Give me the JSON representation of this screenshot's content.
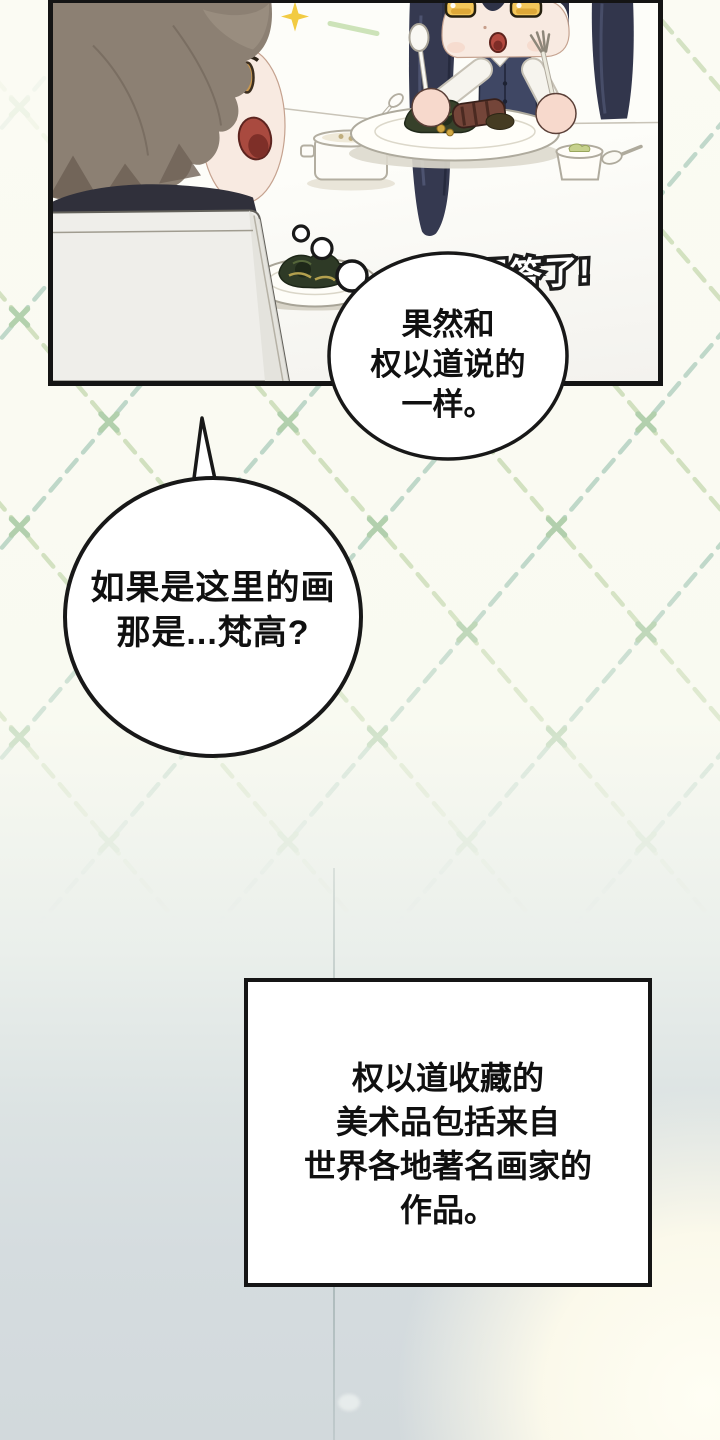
{
  "page": {
    "kind": "webtoon-comic-page",
    "colors": {
      "paper": "#fafaf2",
      "bottom_fade": "#d2d9dc",
      "corner_glow": "#fffdf2",
      "lattice_mint": "#b2d0c0",
      "lattice_green": "#c9dbb5",
      "lattice_cross": "#a3c79e",
      "panel_ink": "#141414",
      "hair_brown": "#8c8073",
      "hair_navy": "#353950",
      "vest_navy": "#3f4764",
      "skin": "#f8eae1",
      "eye_amber": "#f3c65a",
      "mouth_red": "#b04a40",
      "blush_pink": "#edb7a7"
    }
  },
  "panel": {
    "shout": "回答了!",
    "scene_elements": [
      "brown-haired-child-back-profile",
      "navy-twintail-child-eating",
      "dining-table",
      "plate-of-food",
      "soup-pot",
      "side-dish-cup",
      "chair-back",
      "sparkle"
    ]
  },
  "bubble1": {
    "lines": [
      "果然和",
      "权以道说的",
      "一样。"
    ]
  },
  "bubble2": {
    "lines": [
      "如果是这里的画",
      "那是...梵高?"
    ]
  },
  "caption": {
    "lines": [
      "权以道收藏的",
      "美术品包括来自",
      "世界各地著名画家的",
      "作品。"
    ]
  }
}
